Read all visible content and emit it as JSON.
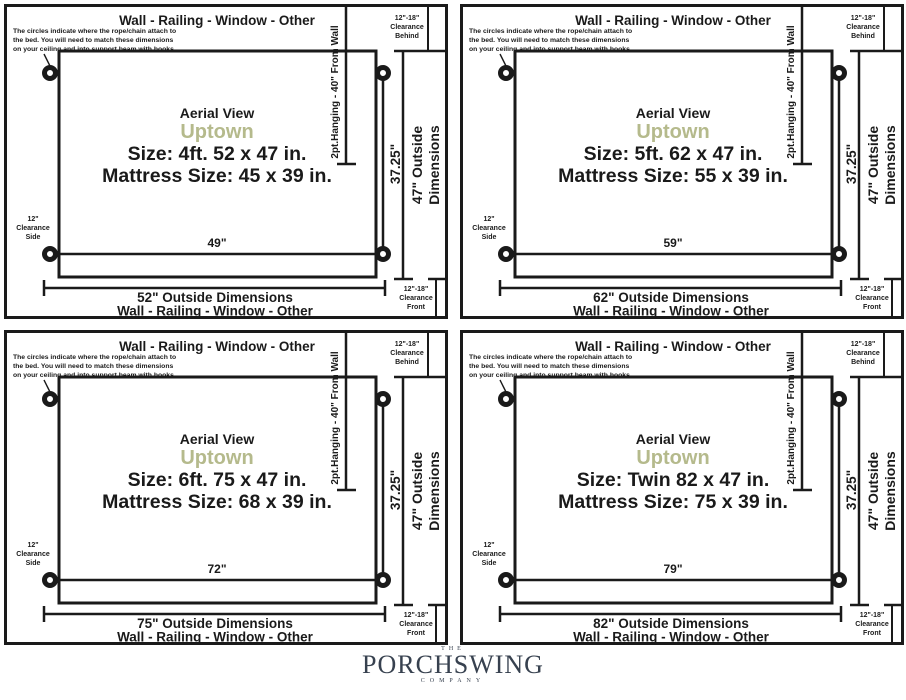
{
  "colors": {
    "ink": "#1a1a1a",
    "model_accent": "#b5ba8c",
    "logo": "#37414f"
  },
  "shared": {
    "wall_label": "Wall - Railing - Window - Other",
    "note": [
      "The circles indicate where the rope/chain attach to",
      "the bed. You will need to match these dimensions",
      "on your ceiling and into support beam with hooks."
    ],
    "aerial_view_label": "Aerial View",
    "model_name": "Uptown",
    "hanging_label": "2pt.Hanging - 40\" From Wall",
    "hang_point_spacing": "37.25\"",
    "outside_depth": [
      "47\" Outside",
      "Dimensions"
    ],
    "clearance_behind": [
      "12\"-18\"",
      "Clearance",
      "Behind"
    ],
    "clearance_front": [
      "12\"-18\"",
      "Clearance",
      "Front"
    ],
    "clearance_side": [
      "12\"",
      "Clearance",
      "Side"
    ]
  },
  "panels": [
    {
      "size_line": "Size: 4ft. 52 x 47 in.",
      "mattress_line": "Mattress Size: 45 x 39 in.",
      "hang_width": "49\"",
      "outside_width": "52\" Outside Dimensions"
    },
    {
      "size_line": "Size: 5ft. 62 x 47 in.",
      "mattress_line": "Mattress Size: 55 x 39 in.",
      "hang_width": "59\"",
      "outside_width": "62\" Outside Dimensions"
    },
    {
      "size_line": "Size: 6ft. 75 x 47 in.",
      "mattress_line": "Mattress Size: 68 x 39 in.",
      "hang_width": "72\"",
      "outside_width": "75\" Outside Dimensions"
    },
    {
      "size_line": "Size: Twin 82 x 47 in.",
      "mattress_line": "Mattress Size: 75 x 39 in.",
      "hang_width": "79\"",
      "outside_width": "82\" Outside Dimensions"
    }
  ],
  "footer": {
    "the": "THE",
    "name": "PORCHSWING",
    "company": "COMPANY"
  }
}
